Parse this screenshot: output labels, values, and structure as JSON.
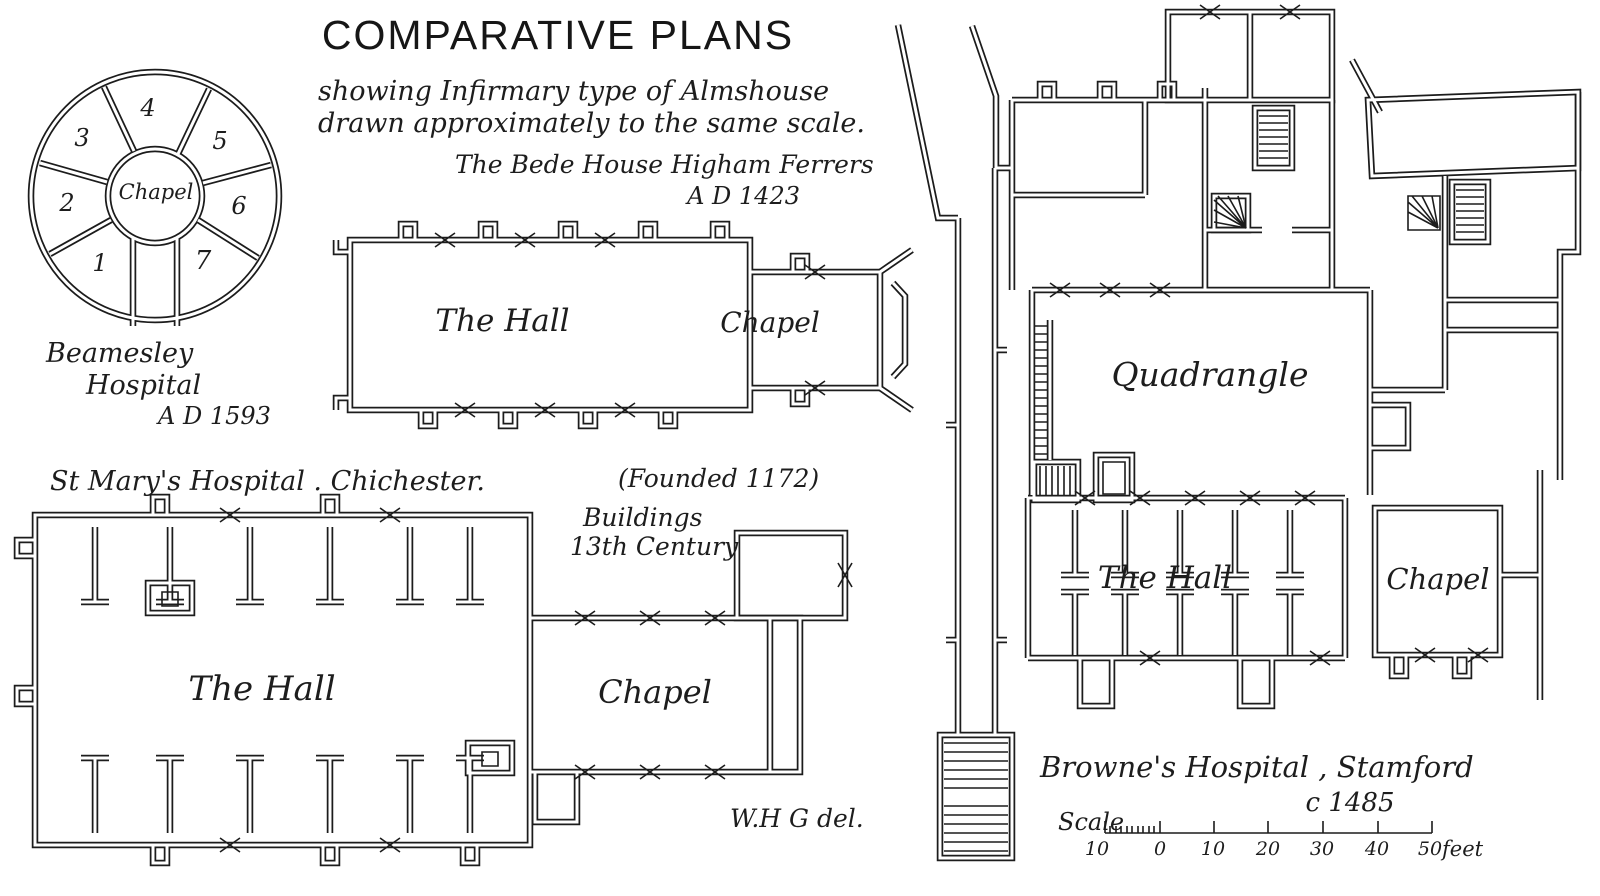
{
  "title": "COMPARATIVE PLANS",
  "subtitle": {
    "line1": "showing Infirmary type of Almshouse",
    "line2": "drawn approximately to the same scale."
  },
  "beamesley": {
    "name_line1": "Beamesley",
    "name_line2": "Hospital",
    "date": "A D 1593",
    "chapel_label": "Chapel",
    "room_numbers": [
      "1",
      "2",
      "3",
      "4",
      "5",
      "6",
      "7"
    ]
  },
  "bede_house": {
    "caption": "The Bede House Higham Ferrers",
    "date": "A D 1423",
    "hall_label": "The Hall",
    "chapel_label": "Chapel"
  },
  "st_marys": {
    "caption": "St Mary's Hospital . Chichester.",
    "founded": "(Founded 1172)",
    "buildings_line1": "Buildings",
    "buildings_line2": "13th Century",
    "hall_label": "The Hall",
    "chapel_label": "Chapel"
  },
  "brownes": {
    "caption": "Browne's Hospital , Stamford",
    "date": "c 1485",
    "quadrangle_label": "Quadrangle",
    "hall_label": "The Hall",
    "chapel_label": "Chapel"
  },
  "scale": {
    "label": "Scale",
    "tick_labels": [
      "10",
      "0",
      "10",
      "20",
      "30",
      "40",
      "50"
    ],
    "unit": "feet"
  },
  "signature": "W.H G del.",
  "colors": {
    "ink": "#1c1c1c",
    "paper": "#ffffff"
  }
}
